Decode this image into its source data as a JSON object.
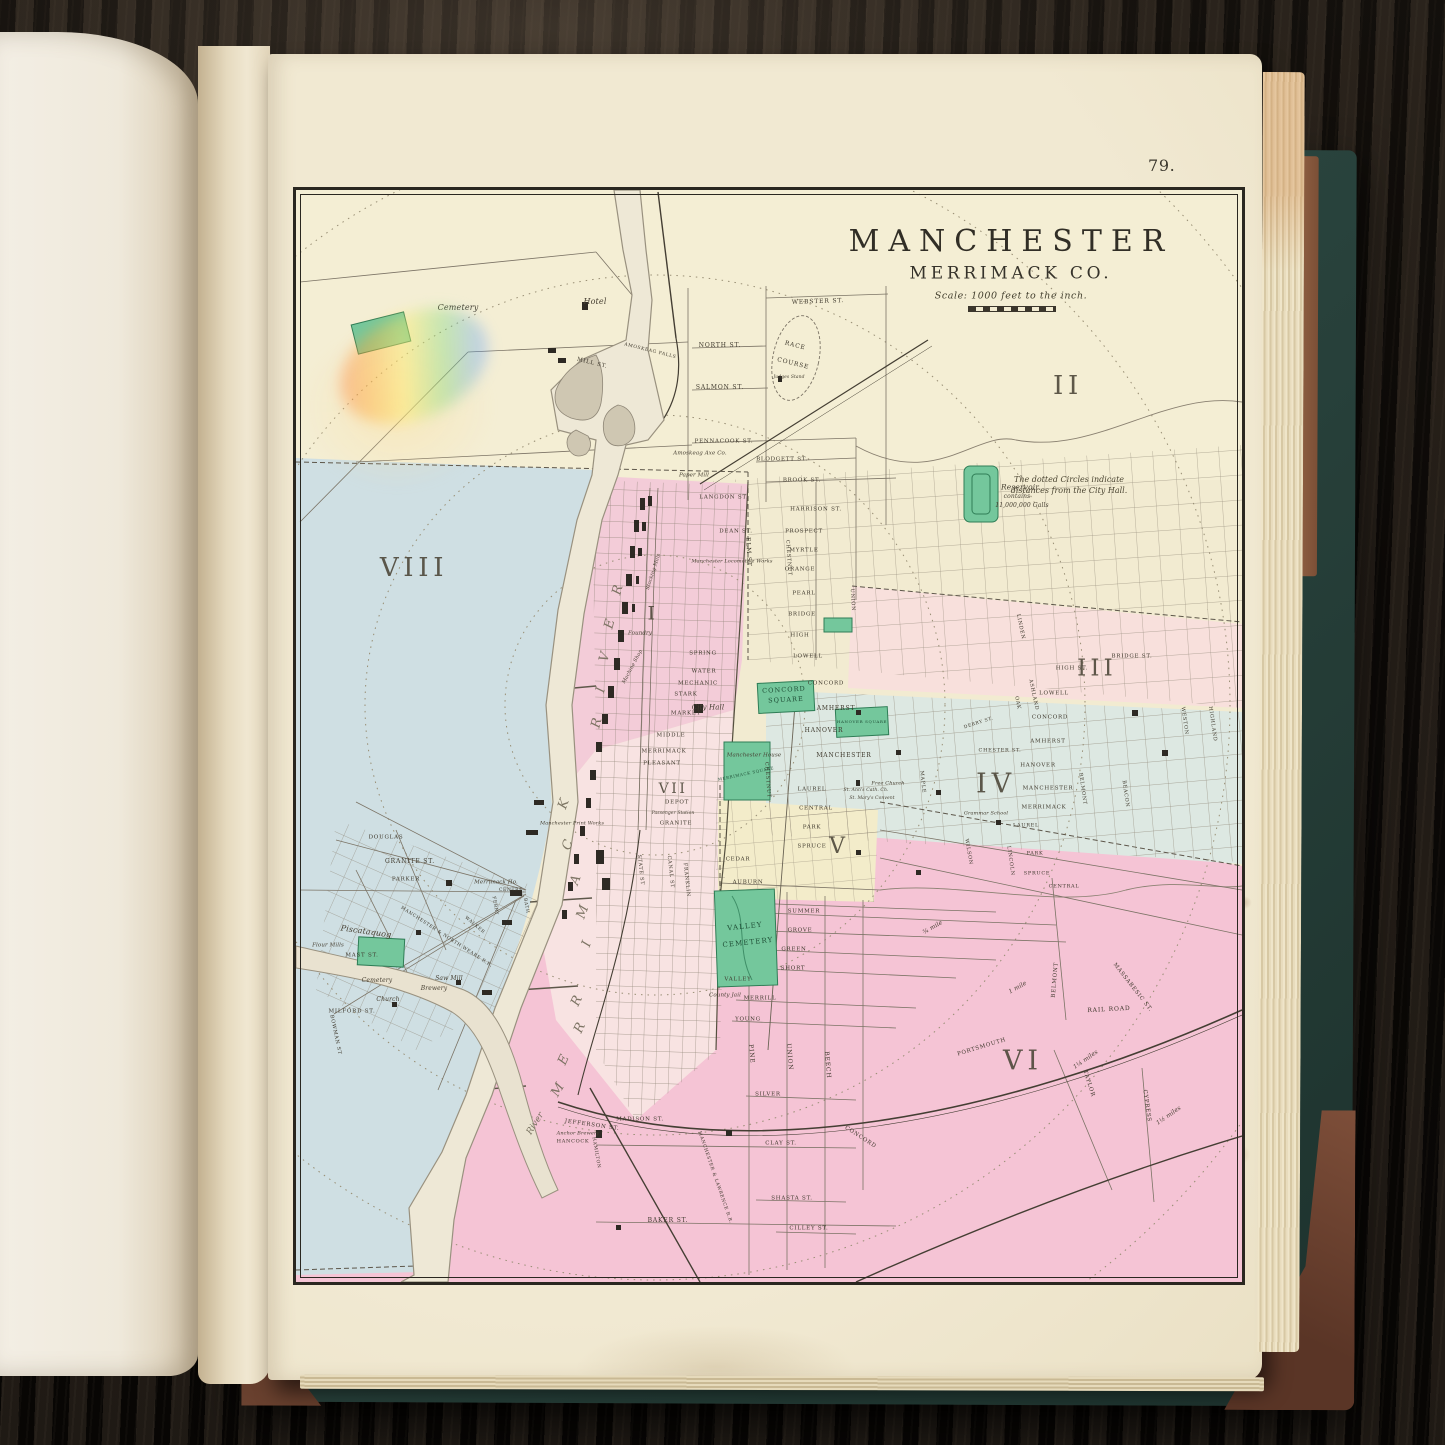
{
  "page": {
    "number": "79."
  },
  "map": {
    "title": "MANCHESTER",
    "subtitle": "MERRIMACK CO.",
    "scale": "Scale: 1000 feet to the inch.",
    "labels": [
      {
        "t": "II",
        "x": 772,
        "y": 196,
        "s": 26,
        "c": "nm"
      },
      {
        "t": "VIII",
        "x": 118,
        "y": 378,
        "s": 26,
        "c": "nm"
      },
      {
        "t": "I",
        "x": 357,
        "y": 424,
        "s": 19,
        "c": "nm"
      },
      {
        "t": "III",
        "x": 801,
        "y": 479,
        "s": 23,
        "c": "nm"
      },
      {
        "t": "IV",
        "x": 700,
        "y": 594,
        "s": 27,
        "c": "nm"
      },
      {
        "t": "V",
        "x": 543,
        "y": 657,
        "s": 22,
        "c": "nm"
      },
      {
        "t": "VI",
        "x": 727,
        "y": 871,
        "s": 27,
        "c": "nm"
      },
      {
        "t": "VII",
        "x": 377,
        "y": 599,
        "s": 14,
        "c": "nm"
      },
      {
        "t": "The dotted Circles indicate",
        "x": 773,
        "y": 290,
        "s": 8,
        "c": "note"
      },
      {
        "t": "distances from the City Hall.",
        "x": 773,
        "y": 301,
        "s": 8,
        "c": "note"
      },
      {
        "t": "Reservoir",
        "x": 724,
        "y": 297,
        "s": 7.5,
        "c": "it"
      },
      {
        "t": "contains",
        "x": 721,
        "y": 307,
        "s": 6,
        "c": "it"
      },
      {
        "t": "11,000,000 Galls",
        "x": 726,
        "y": 316,
        "s": 6,
        "c": "it"
      },
      {
        "t": "Cemetery",
        "x": 162,
        "y": 118,
        "s": 8,
        "c": "it"
      },
      {
        "t": "Hotel",
        "x": 299,
        "y": 112,
        "s": 8,
        "c": "it"
      },
      {
        "t": "MILL ST.",
        "x": 296,
        "y": 174,
        "r": 14,
        "s": 5.5
      },
      {
        "t": "AMOSKEAG FALLS",
        "x": 354,
        "y": 162,
        "r": 14,
        "s": 4.5
      },
      {
        "t": "RACE",
        "x": 499,
        "y": 156,
        "r": 14,
        "s": 6
      },
      {
        "t": "COURSE",
        "x": 497,
        "y": 174,
        "r": 14,
        "s": 6
      },
      {
        "t": "Judges Stand",
        "x": 493,
        "y": 188,
        "s": 4.5,
        "c": "it"
      },
      {
        "t": "WEBSTER ST.",
        "x": 522,
        "y": 112,
        "r": -2,
        "s": 6
      },
      {
        "t": "NORTH ST.",
        "x": 424,
        "y": 156,
        "s": 6
      },
      {
        "t": "SALMON ST.",
        "x": 424,
        "y": 198,
        "s": 6
      },
      {
        "t": "PENNACOOK ST.",
        "x": 428,
        "y": 252,
        "s": 5.5
      },
      {
        "t": "Amoskeag Axe Co.",
        "x": 404,
        "y": 264,
        "s": 5.5,
        "c": "it"
      },
      {
        "t": "Paper Mill",
        "x": 398,
        "y": 286,
        "s": 5.5,
        "c": "it"
      },
      {
        "t": "BLODGETT ST.",
        "x": 486,
        "y": 270,
        "s": 5.5
      },
      {
        "t": "BROOK ST.",
        "x": 506,
        "y": 291,
        "s": 5.5
      },
      {
        "t": "HARRISON ST.",
        "x": 520,
        "y": 320,
        "s": 5.5
      },
      {
        "t": "LANGDON ST.",
        "x": 428,
        "y": 308,
        "s": 5.5
      },
      {
        "t": "DEAN ST.",
        "x": 440,
        "y": 342,
        "s": 5.5
      },
      {
        "t": "Manchester Locomotive Works",
        "x": 436,
        "y": 372,
        "s": 5,
        "c": "it"
      },
      {
        "t": "PROSPECT",
        "x": 508,
        "y": 342,
        "s": 5.5
      },
      {
        "t": "MYRTLE",
        "x": 508,
        "y": 361,
        "s": 5.5
      },
      {
        "t": "ORANGE",
        "x": 504,
        "y": 380,
        "s": 5.5
      },
      {
        "t": "PEARL",
        "x": 508,
        "y": 404,
        "s": 5.5
      },
      {
        "t": "BRIDGE",
        "x": 506,
        "y": 425,
        "s": 5.5
      },
      {
        "t": "HIGH",
        "x": 504,
        "y": 446,
        "s": 5.5
      },
      {
        "t": "LOWELL",
        "x": 512,
        "y": 467,
        "s": 5.5
      },
      {
        "t": "CONCORD",
        "x": 530,
        "y": 494,
        "s": 5.5
      },
      {
        "t": "AMHERST",
        "x": 540,
        "y": 519,
        "s": 6
      },
      {
        "t": "HANOVER",
        "x": 528,
        "y": 541,
        "s": 6
      },
      {
        "t": "MANCHESTER",
        "x": 548,
        "y": 566,
        "s": 6
      },
      {
        "t": "LAUREL",
        "x": 516,
        "y": 600,
        "s": 5.5
      },
      {
        "t": "CENTRAL",
        "x": 520,
        "y": 619,
        "s": 5.5
      },
      {
        "t": "PARK",
        "x": 516,
        "y": 638,
        "s": 5.5
      },
      {
        "t": "SPRUCE",
        "x": 516,
        "y": 657,
        "s": 5.5
      },
      {
        "t": "CEDAR",
        "x": 442,
        "y": 670,
        "s": 5.5
      },
      {
        "t": "AUBURN",
        "x": 452,
        "y": 693,
        "s": 5.5
      },
      {
        "t": "ELM ST",
        "x": 452,
        "y": 362,
        "r": 87,
        "s": 6
      },
      {
        "t": "CHESTNUT",
        "x": 492,
        "y": 368,
        "r": 86,
        "s": 5
      },
      {
        "t": "UNION",
        "x": 556,
        "y": 410,
        "r": 86,
        "s": 5
      },
      {
        "t": "MAPLE",
        "x": 626,
        "y": 592,
        "r": 84,
        "s": 5
      },
      {
        "t": "CHESTNUT",
        "x": 471,
        "y": 590,
        "r": 86,
        "s": 5
      },
      {
        "t": "City Hall",
        "x": 412,
        "y": 518,
        "s": 7,
        "c": "it"
      },
      {
        "t": "CONCORD",
        "x": 488,
        "y": 500,
        "r": -3,
        "s": 6.5,
        "c": "grn"
      },
      {
        "t": "SQUARE",
        "x": 490,
        "y": 510,
        "r": -3,
        "s": 6.5,
        "c": "grn"
      },
      {
        "t": "HANOVER SQUARE",
        "x": 566,
        "y": 532,
        "s": 4,
        "c": "grn"
      },
      {
        "t": "MERRIMACK SQUARE",
        "x": 450,
        "y": 584,
        "r": -12,
        "s": 4,
        "c": "grn"
      },
      {
        "t": "Manchester House",
        "x": 458,
        "y": 566,
        "s": 5.5,
        "c": "it"
      },
      {
        "t": "Free Church",
        "x": 592,
        "y": 594,
        "s": 5,
        "c": "it"
      },
      {
        "t": "St. Ann's Cath. Ch.",
        "x": 570,
        "y": 601,
        "s": 4.5,
        "c": "it"
      },
      {
        "t": "St. Mary's Convent",
        "x": 576,
        "y": 609,
        "s": 4.5,
        "c": "it"
      },
      {
        "t": "Grammar School",
        "x": 690,
        "y": 624,
        "s": 5,
        "c": "it"
      },
      {
        "t": "MARKET",
        "x": 390,
        "y": 524,
        "s": 5.5
      },
      {
        "t": "STARK",
        "x": 390,
        "y": 505,
        "s": 5.5
      },
      {
        "t": "MECHANIC",
        "x": 402,
        "y": 494,
        "s": 5.5
      },
      {
        "t": "WATER",
        "x": 408,
        "y": 482,
        "s": 5.5
      },
      {
        "t": "SPRING",
        "x": 407,
        "y": 464,
        "s": 5.5
      },
      {
        "t": "MIDDLE",
        "x": 375,
        "y": 546,
        "s": 5.5
      },
      {
        "t": "MERRIMACK",
        "x": 368,
        "y": 562,
        "s": 5.5
      },
      {
        "t": "PLEASANT",
        "x": 366,
        "y": 574,
        "s": 5.5
      },
      {
        "t": "DEPOT",
        "x": 381,
        "y": 613,
        "s": 5.5
      },
      {
        "t": "GRANITE",
        "x": 380,
        "y": 634,
        "s": 5.5
      },
      {
        "t": "Passenger Station",
        "x": 377,
        "y": 624,
        "s": 4.5,
        "c": "it"
      },
      {
        "t": "Manchester Print Works",
        "x": 276,
        "y": 634,
        "s": 5,
        "c": "it"
      },
      {
        "t": "STATE ST",
        "x": 344,
        "y": 680,
        "r": 84,
        "s": 5
      },
      {
        "t": "CANAL ST",
        "x": 374,
        "y": 682,
        "r": 84,
        "s": 5
      },
      {
        "t": "FRANKLIN",
        "x": 390,
        "y": 690,
        "r": 84,
        "s": 5
      },
      {
        "t": "Stocking Mills",
        "x": 358,
        "y": 382,
        "r": -72,
        "s": 5,
        "c": "it"
      },
      {
        "t": "Foundry",
        "x": 344,
        "y": 444,
        "s": 5.5,
        "c": "it"
      },
      {
        "t": "Machine Shop",
        "x": 337,
        "y": 477,
        "r": -62,
        "s": 5,
        "c": "it"
      },
      {
        "t": "R",
        "x": 322,
        "y": 400,
        "r": -75,
        "s": 13,
        "c": "riv"
      },
      {
        "t": "E",
        "x": 314,
        "y": 434,
        "r": -75,
        "s": 13,
        "c": "riv"
      },
      {
        "t": "V",
        "x": 309,
        "y": 467,
        "r": -75,
        "s": 13,
        "c": "riv"
      },
      {
        "t": "I",
        "x": 305,
        "y": 500,
        "r": -75,
        "s": 13,
        "c": "riv"
      },
      {
        "t": "R",
        "x": 301,
        "y": 533,
        "r": -75,
        "s": 13,
        "c": "riv"
      },
      {
        "t": "K",
        "x": 268,
        "y": 614,
        "r": -70,
        "s": 13,
        "c": "riv"
      },
      {
        "t": "C",
        "x": 272,
        "y": 655,
        "r": -70,
        "s": 13,
        "c": "riv"
      },
      {
        "t": "A",
        "x": 280,
        "y": 690,
        "r": -70,
        "s": 13,
        "c": "riv"
      },
      {
        "t": "M",
        "x": 287,
        "y": 722,
        "r": -70,
        "s": 13,
        "c": "riv"
      },
      {
        "t": "I",
        "x": 291,
        "y": 754,
        "r": -70,
        "s": 13,
        "c": "riv"
      },
      {
        "t": "R",
        "x": 281,
        "y": 811,
        "r": -65,
        "s": 13,
        "c": "riv"
      },
      {
        "t": "R",
        "x": 284,
        "y": 838,
        "r": -65,
        "s": 13,
        "c": "riv"
      },
      {
        "t": "E",
        "x": 268,
        "y": 870,
        "r": -65,
        "s": 13,
        "c": "riv"
      },
      {
        "t": "M",
        "x": 262,
        "y": 900,
        "r": -60,
        "s": 13,
        "c": "riv"
      },
      {
        "t": "River",
        "x": 240,
        "y": 934,
        "r": -58,
        "s": 9,
        "c": "riv"
      },
      {
        "t": "Piscataquog",
        "x": 70,
        "y": 742,
        "r": 8,
        "s": 8,
        "c": "it"
      },
      {
        "t": "Flour Mills",
        "x": 32,
        "y": 756,
        "s": 5.5,
        "c": "it"
      },
      {
        "t": "MAST ST.",
        "x": 66,
        "y": 766,
        "s": 5.5
      },
      {
        "t": "DOUGLAS",
        "x": 90,
        "y": 648,
        "s": 5.5
      },
      {
        "t": "GRANITE ST.",
        "x": 114,
        "y": 672,
        "s": 6
      },
      {
        "t": "PARKER",
        "x": 110,
        "y": 690,
        "s": 5.5
      },
      {
        "t": "Merrimack Ho.",
        "x": 200,
        "y": 693,
        "s": 5.5,
        "c": "it"
      },
      {
        "t": "CENTRE",
        "x": 215,
        "y": 701,
        "s": 4.5
      },
      {
        "t": "FERRY",
        "x": 198,
        "y": 716,
        "r": 80,
        "s": 4.5
      },
      {
        "t": "BATH",
        "x": 229,
        "y": 716,
        "r": 80,
        "s": 4.5
      },
      {
        "t": "WALKER",
        "x": 178,
        "y": 736,
        "r": 40,
        "s": 4.5
      },
      {
        "t": "MANCHESTER & NORTH WEARE R.R.",
        "x": 150,
        "y": 748,
        "r": 33,
        "s": 4.5
      },
      {
        "t": "Saw Mill",
        "x": 153,
        "y": 789,
        "s": 6,
        "c": "it"
      },
      {
        "t": "Brewery",
        "x": 138,
        "y": 799,
        "s": 6,
        "c": "it"
      },
      {
        "t": "Church",
        "x": 92,
        "y": 810,
        "s": 6,
        "c": "it"
      },
      {
        "t": "Cemetery",
        "x": 81,
        "y": 791,
        "s": 6,
        "c": "it"
      },
      {
        "t": "MILFORD ST.",
        "x": 56,
        "y": 822,
        "s": 5.5
      },
      {
        "t": "BOWMAN ST",
        "x": 39,
        "y": 845,
        "r": 78,
        "s": 5
      },
      {
        "t": "VALLEY",
        "x": 449,
        "y": 737,
        "r": -6,
        "s": 7,
        "c": "grn"
      },
      {
        "t": "CEMETERY",
        "x": 452,
        "y": 753,
        "r": -6,
        "s": 7,
        "c": "grn"
      },
      {
        "t": "VALLEY",
        "x": 442,
        "y": 790,
        "s": 5.5
      },
      {
        "t": "County Jail",
        "x": 429,
        "y": 806,
        "s": 5.5,
        "c": "it"
      },
      {
        "t": "SUMMER",
        "x": 508,
        "y": 722,
        "s": 5.5
      },
      {
        "t": "GROVE",
        "x": 504,
        "y": 741,
        "s": 5.5
      },
      {
        "t": "GREEN",
        "x": 498,
        "y": 760,
        "s": 5.5
      },
      {
        "t": "SHORT",
        "x": 497,
        "y": 779,
        "s": 5.5
      },
      {
        "t": "MERRILL",
        "x": 464,
        "y": 809,
        "s": 5.5
      },
      {
        "t": "YOUNG",
        "x": 452,
        "y": 830,
        "s": 5.5
      },
      {
        "t": "SILVER",
        "x": 472,
        "y": 905,
        "s": 5.5
      },
      {
        "t": "PINE",
        "x": 455,
        "y": 864,
        "r": 85,
        "s": 6
      },
      {
        "t": "UNION",
        "x": 493,
        "y": 867,
        "r": 85,
        "s": 6
      },
      {
        "t": "BEECH",
        "x": 531,
        "y": 875,
        "r": 85,
        "s": 6
      },
      {
        "t": "MADISON ST.",
        "x": 344,
        "y": 930,
        "s": 5.5
      },
      {
        "t": "JEFFERSON ST.",
        "x": 296,
        "y": 936,
        "r": 8,
        "s": 5.5
      },
      {
        "t": "Anchor Brewery",
        "x": 282,
        "y": 944,
        "s": 5,
        "c": "it"
      },
      {
        "t": "HANCOCK",
        "x": 277,
        "y": 952,
        "s": 5
      },
      {
        "t": "HAMILTON",
        "x": 299,
        "y": 963,
        "r": 80,
        "s": 4.5
      },
      {
        "t": "CLAY ST.",
        "x": 485,
        "y": 954,
        "s": 5.5
      },
      {
        "t": "SHASTA ST.",
        "x": 496,
        "y": 1009,
        "s": 5.5
      },
      {
        "t": "BAKER ST.",
        "x": 372,
        "y": 1031,
        "s": 6
      },
      {
        "t": "CILLEY ST.",
        "x": 513,
        "y": 1039,
        "s": 5.5
      },
      {
        "t": "CONCORD",
        "x": 564,
        "y": 948,
        "r": 33,
        "s": 5.5
      },
      {
        "t": "MANCHESTER & LAWRENCE R.R.",
        "x": 418,
        "y": 988,
        "r": 71,
        "s": 4.5
      },
      {
        "t": "PORTSMOUTH",
        "x": 686,
        "y": 858,
        "r": -17,
        "s": 5.5
      },
      {
        "t": "RAIL ROAD",
        "x": 813,
        "y": 820,
        "r": -3,
        "s": 6
      },
      {
        "t": "BELMONT",
        "x": 760,
        "y": 790,
        "r": -85,
        "s": 5.5
      },
      {
        "t": "TAYLOR",
        "x": 792,
        "y": 894,
        "r": 72,
        "s": 5.5
      },
      {
        "t": "CYPRESS",
        "x": 850,
        "y": 916,
        "r": 82,
        "s": 5.5
      },
      {
        "t": "MASSABESIC ST.",
        "x": 836,
        "y": 798,
        "r": 52,
        "s": 5.5
      },
      {
        "t": "¾ mile",
        "x": 637,
        "y": 738,
        "r": -30,
        "s": 6,
        "c": "it"
      },
      {
        "t": "1 mile",
        "x": 722,
        "y": 798,
        "r": -30,
        "s": 6,
        "c": "it"
      },
      {
        "t": "1¼ miles",
        "x": 790,
        "y": 870,
        "r": -35,
        "s": 6,
        "c": "it"
      },
      {
        "t": "1½ miles",
        "x": 873,
        "y": 926,
        "r": -35,
        "s": 6,
        "c": "it"
      },
      {
        "t": "BRIDGE ST.",
        "x": 836,
        "y": 467,
        "s": 5.5
      },
      {
        "t": "HIGH ST.",
        "x": 776,
        "y": 479,
        "s": 5.5
      },
      {
        "t": "LOWELL",
        "x": 758,
        "y": 504,
        "s": 5.5
      },
      {
        "t": "CONCORD",
        "x": 754,
        "y": 528,
        "s": 5.5
      },
      {
        "t": "AMHERST",
        "x": 752,
        "y": 552,
        "s": 5.5
      },
      {
        "t": "CHESTER ST.",
        "x": 704,
        "y": 561,
        "s": 5
      },
      {
        "t": "HANOVER",
        "x": 742,
        "y": 576,
        "s": 5.5
      },
      {
        "t": "MANCHESTER",
        "x": 752,
        "y": 599,
        "s": 5.5
      },
      {
        "t": "MERRIMACK",
        "x": 748,
        "y": 618,
        "s": 5.5
      },
      {
        "t": "LAUREL",
        "x": 730,
        "y": 636,
        "s": 5
      },
      {
        "t": "DERRY ST.",
        "x": 683,
        "y": 534,
        "r": -18,
        "s": 4.5
      },
      {
        "t": "ASHLAND",
        "x": 737,
        "y": 505,
        "r": 78,
        "s": 5
      },
      {
        "t": "OAK",
        "x": 721,
        "y": 513,
        "r": 78,
        "s": 5
      },
      {
        "t": "LINDEN",
        "x": 724,
        "y": 437,
        "r": 78,
        "s": 5
      },
      {
        "t": "WESTON",
        "x": 888,
        "y": 531,
        "r": 82,
        "s": 5
      },
      {
        "t": "HIGHLAND",
        "x": 916,
        "y": 534,
        "r": 82,
        "s": 5
      },
      {
        "t": "BELMONT",
        "x": 786,
        "y": 599,
        "r": 82,
        "s": 5
      },
      {
        "t": "BEACON",
        "x": 829,
        "y": 604,
        "r": 82,
        "s": 5
      },
      {
        "t": "LINCOLN",
        "x": 714,
        "y": 671,
        "r": 82,
        "s": 5
      },
      {
        "t": "WILSON",
        "x": 672,
        "y": 662,
        "r": 80,
        "s": 5
      },
      {
        "t": "PARK",
        "x": 739,
        "y": 664,
        "s": 5
      },
      {
        "t": "SPRUCE",
        "x": 741,
        "y": 684,
        "s": 5
      },
      {
        "t": "CENTRAL",
        "x": 768,
        "y": 697,
        "s": 5
      }
    ]
  }
}
